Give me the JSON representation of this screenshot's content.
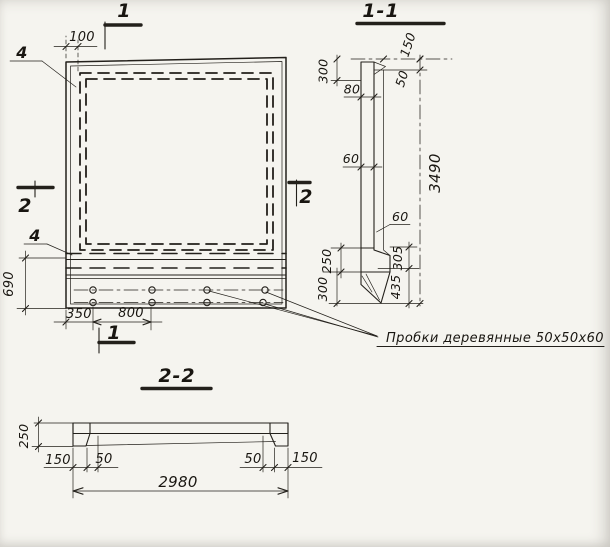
{
  "meta": {
    "paper_color": "#f5f4ef",
    "ink_color": "#23201b",
    "drawing_type": "precast concrete panel working drawing"
  },
  "front_view": {
    "section_mark_top": "1",
    "section_mark_bottom": "1",
    "section_mark_left": "2",
    "section_mark_right": "2",
    "callout_top": "4",
    "callout_bottom": "4",
    "dim_mesh_offset": "100",
    "dim_base_height": "690",
    "dim_edge_to_plug": "350",
    "dim_plug_spacing": "800"
  },
  "annotation": {
    "plug_note": "Пробки деревянные 50х50х60"
  },
  "section_1_1": {
    "title": "1-1",
    "dim_top_ledge_height": "300",
    "dim_ledge_width": "80",
    "dim_axis_offset": "150",
    "dim_top_drop": "50",
    "dim_panel_thickness": "60",
    "dim_rib_width": "60",
    "dim_base_upper": "250",
    "dim_base_lower": "300",
    "dim_right_upper": "305",
    "dim_right_lower": "435",
    "dim_total_height": "3490"
  },
  "section_2_2": {
    "title": "2-2",
    "dim_thickness": "250",
    "dim_left_edge": "150",
    "dim_left_rib": "50",
    "dim_right_rib": "50",
    "dim_right_edge": "150",
    "dim_total_width": "2980"
  }
}
